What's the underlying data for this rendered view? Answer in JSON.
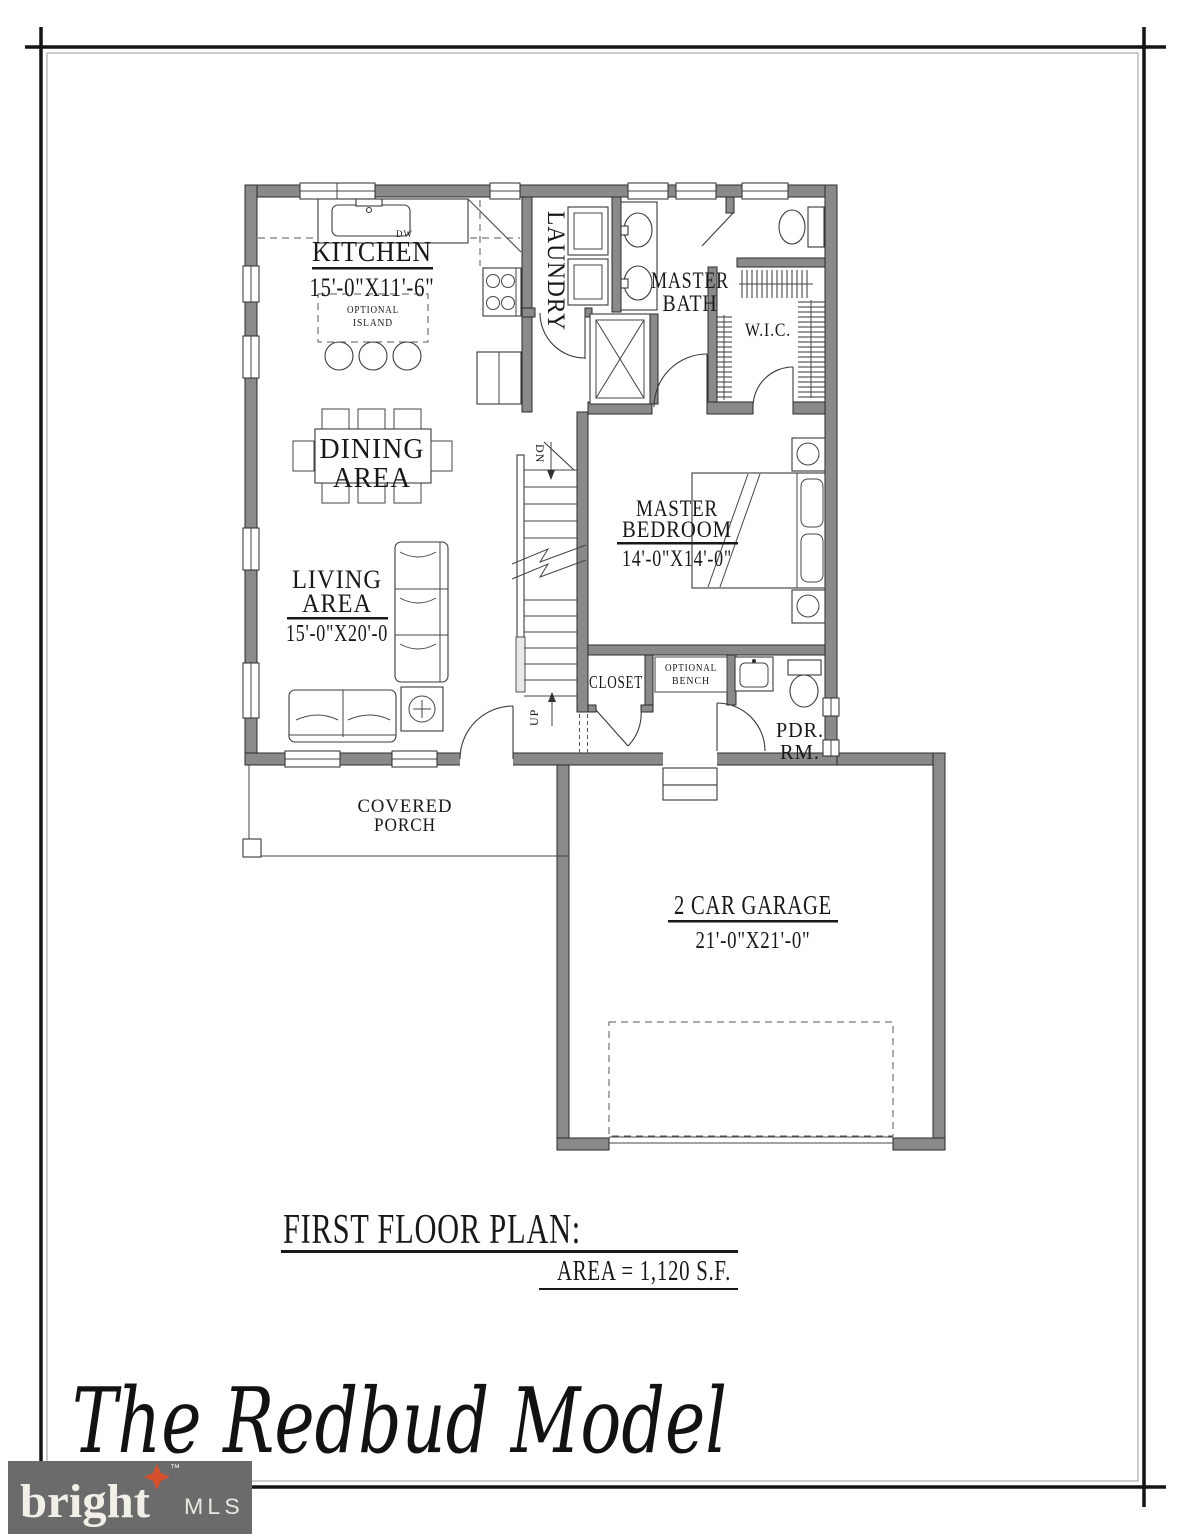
{
  "page": {
    "background": "#ffffff",
    "wall_color": "#8a8a8a",
    "line_color": "#2b2b2b"
  },
  "plan": {
    "rooms": {
      "kitchen": {
        "name": "KITCHEN",
        "dims": "15'-0\"X11'-6\""
      },
      "island": {
        "line1": "OPTIONAL",
        "line2": "ISLAND"
      },
      "laundry": {
        "name": "LAUNDRY"
      },
      "master_bath": {
        "line1": "MASTER",
        "line2": "BATH"
      },
      "wic": {
        "name": "W.I.C."
      },
      "dining": {
        "line1": "DINING",
        "line2": "AREA"
      },
      "master_bedroom": {
        "line1": "MASTER",
        "line2": "BEDROOM",
        "dims": "14'-0\"X14'-0\""
      },
      "living": {
        "line1": "LIVING",
        "line2": "AREA",
        "dims": "15'-0\"X20'-0"
      },
      "closet": {
        "name": "CLOSET"
      },
      "bench": {
        "line1": "OPTIONAL",
        "line2": "BENCH"
      },
      "powder_room": {
        "line1": "PDR.",
        "line2": "RM."
      },
      "porch": {
        "line1": "COVERED",
        "line2": "PORCH"
      },
      "garage": {
        "name": "2 CAR GARAGE",
        "dims": "21'-0\"X21'-0\""
      }
    },
    "annotations": {
      "down": "DN",
      "up": "UP",
      "dishwasher": "DW"
    }
  },
  "title_block": {
    "heading": "FIRST FLOOR PLAN:",
    "area": "AREA = 1,120 S.F."
  },
  "model_name": "The Redbud Model",
  "logo": {
    "brand": "bright",
    "trademark": "™",
    "suffix": "MLS",
    "background": "#6b6b6b",
    "star_color": "#d4502e"
  }
}
